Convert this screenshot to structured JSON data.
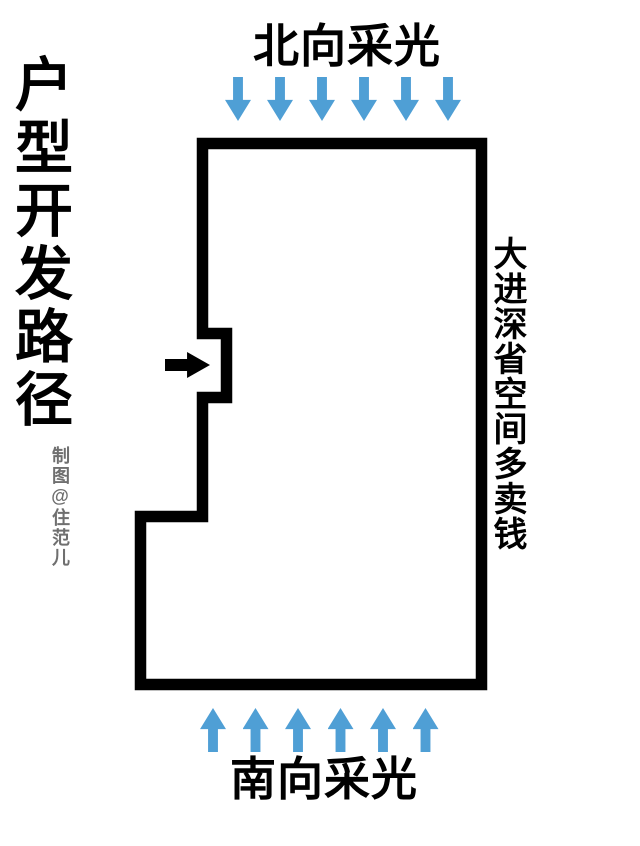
{
  "title": {
    "text": "户型开发路径"
  },
  "credit": {
    "text": "制图@住范儿"
  },
  "north_light": {
    "label": "北向采光",
    "arrow_direction": "down",
    "arrow_count": 6
  },
  "south_light": {
    "label": "南向采光",
    "arrow_direction": "up",
    "arrow_count": 6
  },
  "right_note": {
    "label": "大进深省空间多卖钱"
  },
  "entrance": {
    "arrow_direction": "right"
  },
  "colors": {
    "light_arrow_blue": "#4f9fd5",
    "wall_black": "#000000",
    "credit_gray": "#6f6f6f",
    "background": "#ffffff"
  }
}
